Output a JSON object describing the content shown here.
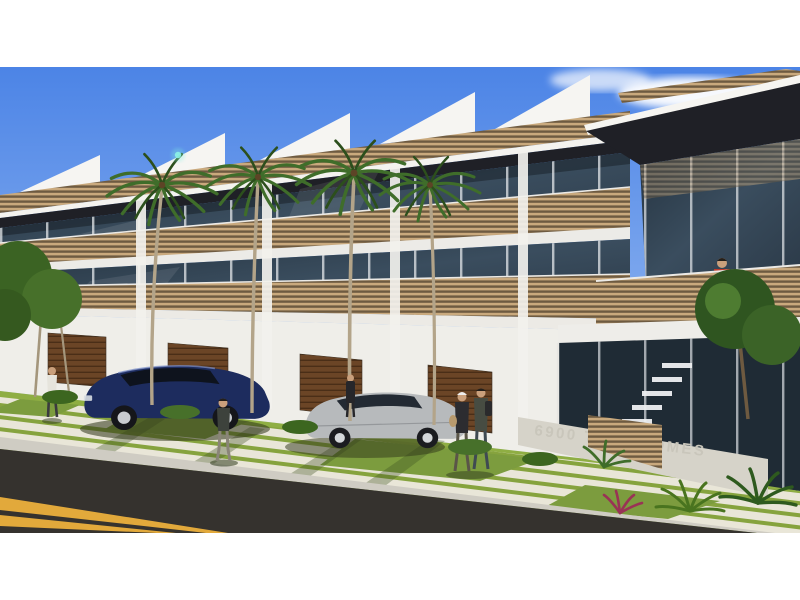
{
  "photo": {
    "kind": "3D architectural rendering",
    "subject": "Modern three-story townhome complex with wood-slat balconies, glass facades, palm trees, parked cars and pedestrians on a sunny day",
    "sign": {
      "text": "6900 TOWNHOMES"
    },
    "colors": {
      "sky_top": "#4c84e6",
      "sky_horizon": "#c6ddf4",
      "cloud_white": "#ffffff",
      "roof_dark": "#1f2026",
      "wall_white": "#efeee9",
      "wood_slat": "#c9a97d",
      "garage_wood": "#6b4526",
      "glass_dark": "#2b3947",
      "lawn_green": "#8fae43",
      "paver_light": "#e9e6d8",
      "road_asphalt": "#35322e",
      "lane_yellow": "#e2a93b",
      "palm_green": "#3f6d2a",
      "car_navy": "#1d2c5e",
      "car_silver": "#b7babc",
      "balcony_shirt_red": "#c23b2c",
      "sign_letters": "#c9c6bb",
      "letterbox": "#ffffff"
    },
    "objects": {
      "vehicles": [
        "dark navy sedan parked in driveway",
        "silver sedan parked in driveway"
      ],
      "people": [
        "pedestrian on left lawn",
        "person walking on center walkway",
        "couple walking near entry walk",
        "person by the garages",
        "resident in red shirt on upper balcony"
      ],
      "vegetation": [
        "tall royal palms along the walkways",
        "shade trees at left and right edges",
        "tropical shrubs and palmettos in the foreground"
      ],
      "street": "asphalt road with double yellow center line at lower left"
    }
  }
}
